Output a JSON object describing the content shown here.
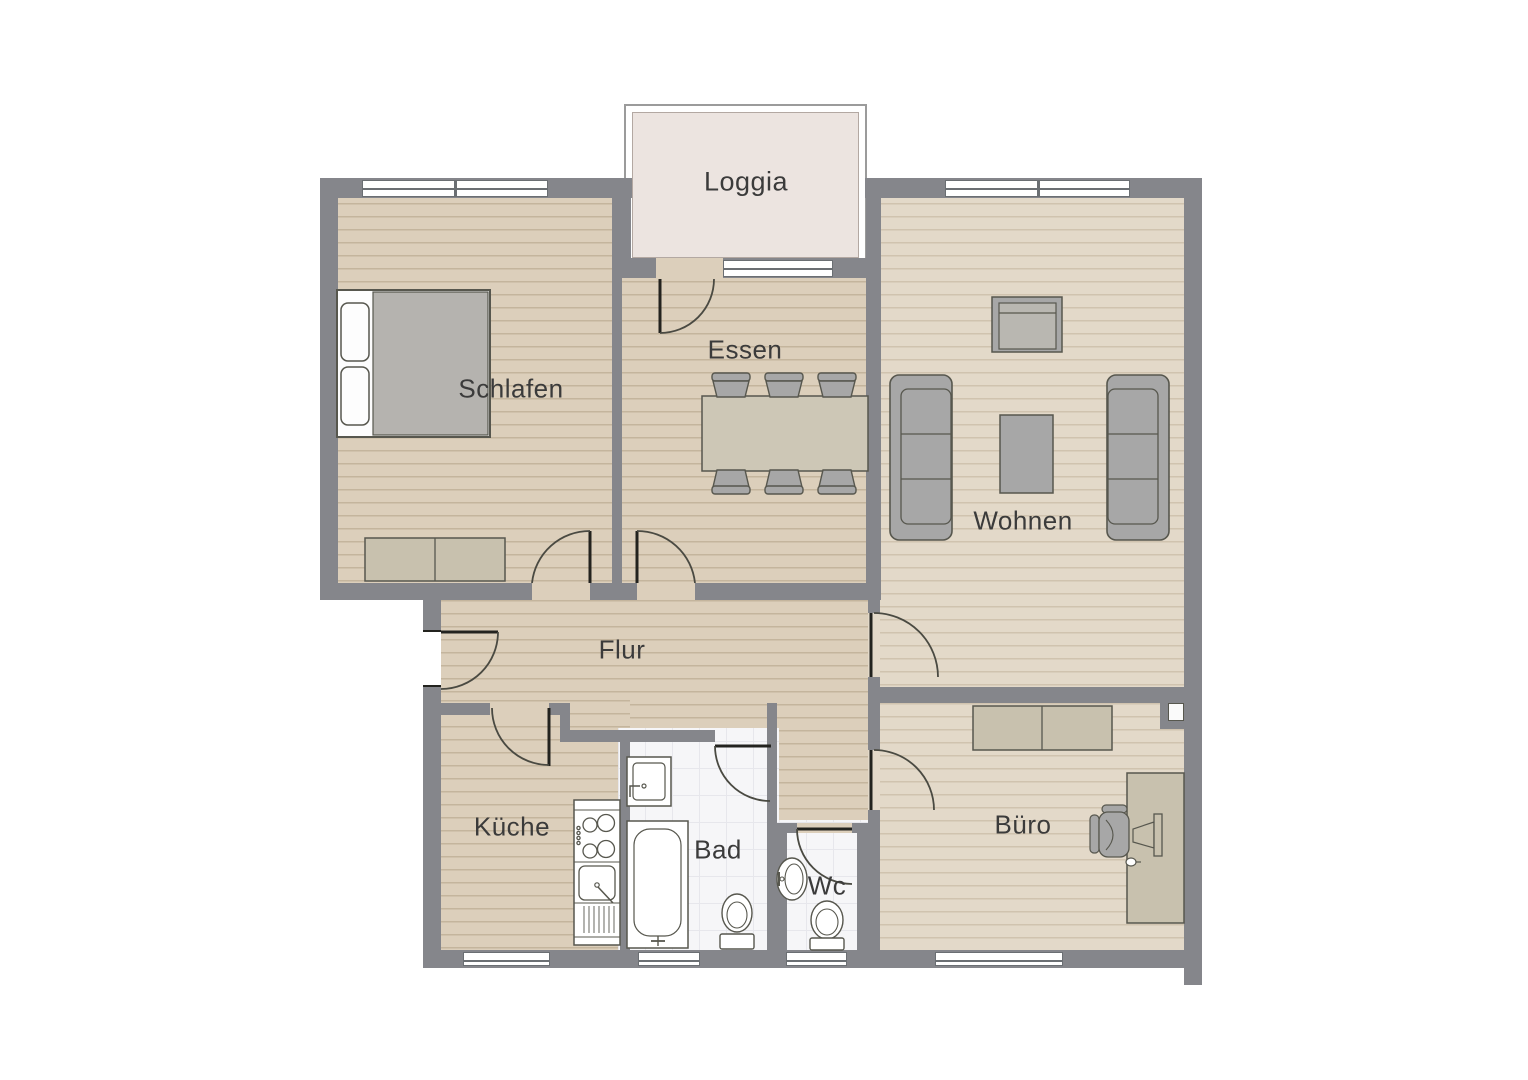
{
  "plan": {
    "type": "apartment-floorplan",
    "rooms": {
      "loggia": {
        "label": "Loggia"
      },
      "schlafen": {
        "label": "Schlafen"
      },
      "essen": {
        "label": "Essen"
      },
      "wohnen": {
        "label": "Wohnen"
      },
      "flur": {
        "label": "Flur"
      },
      "kueche": {
        "label": "Küche"
      },
      "bad": {
        "label": "Bad"
      },
      "wc": {
        "label": "Wc"
      },
      "buero": {
        "label": "Büro"
      }
    },
    "colors": {
      "wall": "#85868b",
      "wood_floor": "#dccfbb",
      "wood_floor_light": "#e3d9c9",
      "tile_floor": "#f6f6f8",
      "loggia_floor": "#ece4e0",
      "furniture_gray": "#a7a7a7",
      "furniture_beige": "#c8c1ae",
      "fixture_white": "#ffffff",
      "outline": "#57574e",
      "label_text": "#3b3b3b"
    }
  }
}
